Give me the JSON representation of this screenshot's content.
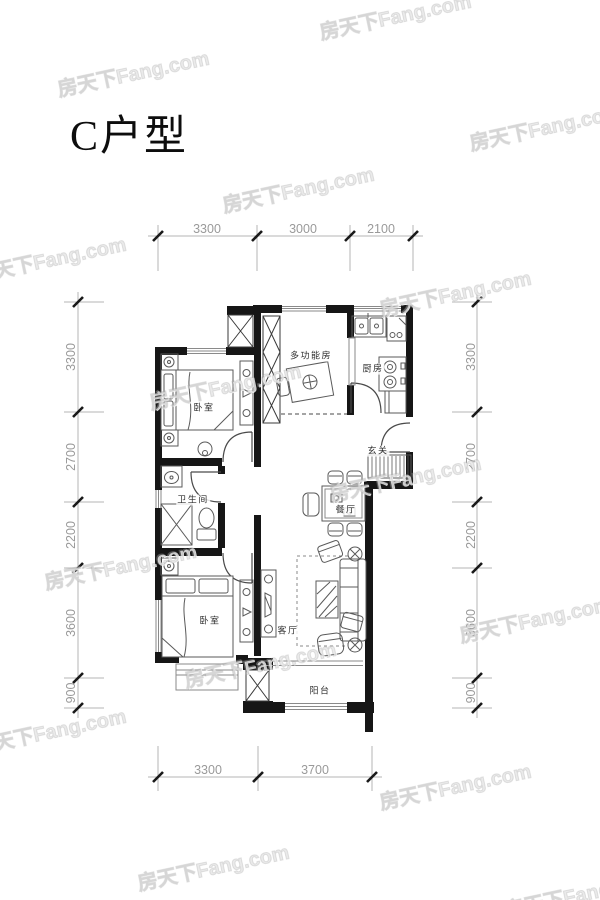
{
  "page": {
    "title": "C户型"
  },
  "watermark": {
    "text": "房天下Fang.com"
  },
  "colors": {
    "wall": "#161616",
    "furniture_line": "#5a5a5a",
    "window_line": "#8a8a8a",
    "dimension_line": "#b5b5b5",
    "dimension_text": "#9a9a9a",
    "room_text": "#2f2f2f"
  },
  "plan": {
    "rooms": [
      {
        "name": "多功能房"
      },
      {
        "name": "厨房"
      },
      {
        "name": "卧室"
      },
      {
        "name": "玄关"
      },
      {
        "name": "餐厅"
      },
      {
        "name": "卫生间"
      },
      {
        "name": "客厅"
      },
      {
        "name": "卧室"
      },
      {
        "name": "阳台"
      }
    ],
    "dimensions": {
      "top": [
        "3300",
        "3000",
        "2100"
      ],
      "bottom": [
        "3300",
        "3700"
      ],
      "left": [
        "3300",
        "2700",
        "2200",
        "3600",
        "900"
      ],
      "right": [
        "3300",
        "2700",
        "2200",
        "3600",
        "900"
      ]
    }
  }
}
